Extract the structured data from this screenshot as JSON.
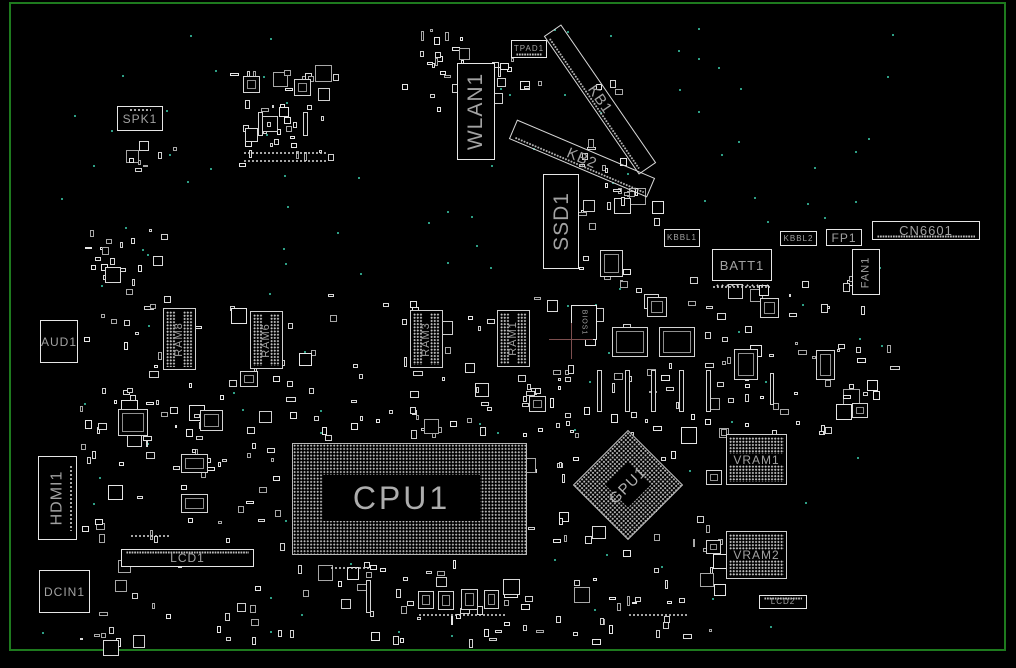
{
  "board": {
    "title": "motherboard-boardview",
    "bg_color": "#000000",
    "frame_color": "#1e7a1e",
    "outline_color": "#d9d9d9",
    "label_color": "#a2a2a2",
    "dot_color": "#c4c4c4",
    "testpoint_color": "#2e9e85",
    "crosshair": {
      "x": 571,
      "y": 339,
      "h_from": 549,
      "h_to": 593,
      "v_from": 323,
      "v_to": 359,
      "color": "#7d4f4f"
    },
    "frame": {
      "left": 9,
      "top": 2,
      "width": 997,
      "height": 649
    }
  },
  "components": [
    {
      "id": "spk1",
      "label": "SPK1",
      "kind": "box",
      "x": 117,
      "y": 106,
      "w": 46,
      "h": 25,
      "fs": 12,
      "pins": "top"
    },
    {
      "id": "tpad1",
      "label": "TPAD1",
      "kind": "box",
      "x": 511,
      "y": 40,
      "w": 36,
      "h": 18,
      "fs": 8,
      "hatch": "bottom"
    },
    {
      "id": "wlan1",
      "label": "WLAN1",
      "kind": "box",
      "x": 457,
      "y": 63,
      "w": 38,
      "h": 97,
      "fs": 21,
      "lrot": -90
    },
    {
      "id": "kb1",
      "label": "KB1",
      "kind": "diag",
      "x": 600,
      "y": 99,
      "w": 168,
      "h": 21,
      "fs": 15,
      "rot": 55.5
    },
    {
      "id": "kb2",
      "label": "KB2",
      "kind": "diag",
      "x": 582,
      "y": 158,
      "w": 150,
      "h": 21,
      "fs": 15,
      "rot": 23
    },
    {
      "id": "ssd1",
      "label": "SSD1",
      "kind": "box",
      "x": 543,
      "y": 174,
      "w": 36,
      "h": 95,
      "fs": 21,
      "lrot": -90
    },
    {
      "id": "kbbl1",
      "label": "KBBL1",
      "kind": "box",
      "x": 664,
      "y": 229,
      "w": 36,
      "h": 18,
      "fs": 8
    },
    {
      "id": "batt1",
      "label": "BATT1",
      "kind": "box",
      "x": 712,
      "y": 249,
      "w": 60,
      "h": 32,
      "fs": 13,
      "pins": "bottom"
    },
    {
      "id": "kbbl2",
      "label": "KBBL2",
      "kind": "box",
      "x": 780,
      "y": 231,
      "w": 37,
      "h": 15,
      "fs": 8
    },
    {
      "id": "fp1",
      "label": "FP1",
      "kind": "box",
      "x": 826,
      "y": 229,
      "w": 36,
      "h": 17,
      "fs": 12
    },
    {
      "id": "cn6601",
      "label": "CN6601",
      "kind": "box",
      "x": 872,
      "y": 221,
      "w": 108,
      "h": 19,
      "fs": 13,
      "hatch": "bottom"
    },
    {
      "id": "fan1",
      "label": "FAN1",
      "kind": "box",
      "x": 852,
      "y": 249,
      "w": 28,
      "h": 46,
      "fs": 11,
      "lrot": -90
    },
    {
      "id": "aud1",
      "label": "AUD1",
      "kind": "box",
      "x": 40,
      "y": 320,
      "w": 38,
      "h": 43,
      "fs": 12
    },
    {
      "id": "hdmi1",
      "label": "HDMI1",
      "kind": "box",
      "x": 38,
      "y": 456,
      "w": 39,
      "h": 84,
      "fs": 16,
      "lrot": -90,
      "pins": "right"
    },
    {
      "id": "dcin1",
      "label": "DCIN1",
      "kind": "box",
      "x": 39,
      "y": 570,
      "w": 51,
      "h": 43,
      "fs": 12
    },
    {
      "id": "lcd1",
      "label": "LCD1",
      "kind": "box",
      "x": 121,
      "y": 549,
      "w": 133,
      "h": 18,
      "fs": 12,
      "hatch": "top"
    },
    {
      "id": "ram8",
      "label": "RAM8",
      "kind": "ramv",
      "x": 163,
      "y": 308,
      "w": 33,
      "h": 62,
      "fs": 11
    },
    {
      "id": "ram6",
      "label": "RAM6",
      "kind": "ramv",
      "x": 250,
      "y": 311,
      "w": 33,
      "h": 58,
      "fs": 11
    },
    {
      "id": "ram3",
      "label": "RAM3",
      "kind": "ramv",
      "x": 410,
      "y": 310,
      "w": 33,
      "h": 58,
      "fs": 11
    },
    {
      "id": "ram1",
      "label": "RAM1",
      "kind": "ramv",
      "x": 497,
      "y": 310,
      "w": 33,
      "h": 57,
      "fs": 11
    },
    {
      "id": "bios1",
      "label": "BIOS1",
      "kind": "box",
      "x": 571,
      "y": 305,
      "w": 26,
      "h": 35,
      "fs": 7,
      "lrot": 90
    },
    {
      "id": "cpu1",
      "label": "CPU1",
      "kind": "cpu",
      "x": 292,
      "y": 443,
      "w": 235,
      "h": 112,
      "fs": 32
    },
    {
      "id": "gpu1",
      "label": "GPU1",
      "kind": "gpu",
      "x": 589,
      "y": 446,
      "w": 78,
      "h": 78,
      "fs": 15,
      "rot": 45
    },
    {
      "id": "vram1",
      "label": "VRAM1",
      "kind": "ramh",
      "x": 726,
      "y": 434,
      "w": 61,
      "h": 51,
      "fs": 12
    },
    {
      "id": "vram2",
      "label": "VRAM2",
      "kind": "ramh",
      "x": 726,
      "y": 531,
      "w": 61,
      "h": 48,
      "fs": 12
    },
    {
      "id": "lcd2",
      "label": "LCD2",
      "kind": "box",
      "x": 759,
      "y": 595,
      "w": 48,
      "h": 14,
      "fs": 8,
      "hatch": "top"
    }
  ],
  "texture": {
    "clusters": [
      [
        230,
        58,
        105,
        112,
        40,
        11
      ],
      [
        402,
        24,
        66,
        92,
        22,
        12
      ],
      [
        492,
        55,
        50,
        72,
        10,
        13
      ],
      [
        578,
        80,
        54,
        200,
        26,
        14
      ],
      [
        600,
        185,
        60,
        46,
        9,
        15
      ],
      [
        75,
        228,
        88,
        72,
        20,
        16
      ],
      [
        78,
        302,
        84,
        155,
        22,
        17
      ],
      [
        140,
        292,
        430,
        96,
        48,
        18
      ],
      [
        556,
        276,
        336,
        156,
        92,
        19
      ],
      [
        75,
        392,
        228,
        158,
        58,
        20
      ],
      [
        300,
        387,
        258,
        52,
        28,
        21
      ],
      [
        520,
        382,
        58,
        175,
        15,
        22
      ],
      [
        560,
        422,
        160,
        160,
        22,
        23
      ],
      [
        60,
        560,
        500,
        80,
        66,
        24
      ],
      [
        560,
        582,
        160,
        58,
        20,
        25
      ],
      [
        695,
        422,
        30,
        195,
        9,
        26
      ],
      [
        108,
        140,
        76,
        38,
        8,
        27
      ]
    ],
    "ics": [
      [
        612,
        327,
        36,
        30
      ],
      [
        659,
        327,
        36,
        30
      ],
      [
        734,
        349,
        24,
        31
      ],
      [
        816,
        350,
        19,
        30
      ],
      [
        181,
        454,
        27,
        19
      ],
      [
        181,
        494,
        27,
        19
      ],
      [
        118,
        409,
        30,
        27
      ],
      [
        647,
        297,
        20,
        20
      ],
      [
        760,
        298,
        19,
        20
      ],
      [
        600,
        250,
        23,
        27
      ],
      [
        418,
        591,
        16,
        18
      ],
      [
        438,
        591,
        16,
        19
      ],
      [
        461,
        589,
        17,
        21
      ],
      [
        484,
        590,
        15,
        19
      ],
      [
        243,
        76,
        17,
        17
      ],
      [
        294,
        79,
        17,
        17
      ],
      [
        200,
        410,
        23,
        21
      ],
      [
        529,
        396,
        17,
        16
      ],
      [
        852,
        403,
        16,
        15
      ],
      [
        240,
        371,
        18,
        16
      ],
      [
        706,
        470,
        16,
        15
      ],
      [
        706,
        540,
        15,
        14
      ]
    ],
    "vslots": [
      [
        258,
        112,
        5,
        24
      ],
      [
        303,
        112,
        5,
        24
      ],
      [
        597,
        370,
        5,
        42
      ],
      [
        625,
        370,
        5,
        42
      ],
      [
        651,
        370,
        5,
        42
      ],
      [
        679,
        370,
        5,
        42
      ],
      [
        706,
        370,
        5,
        42
      ],
      [
        366,
        580,
        5,
        33
      ],
      [
        770,
        373,
        4,
        32
      ]
    ],
    "hrows": [
      [
        243,
        151,
        85
      ],
      [
        243,
        159,
        85
      ],
      [
        712,
        285,
        58
      ],
      [
        130,
        534,
        40
      ],
      [
        418,
        613,
        88
      ],
      [
        628,
        613,
        60
      ],
      [
        330,
        566,
        40
      ]
    ],
    "testpoints": {
      "count": 125,
      "seed": 5,
      "x0": 58,
      "y0": 26,
      "x1": 893,
      "y1": 640,
      "extra": [
        [
          738,
          141
        ],
        [
          42,
          632
        ],
        [
          500,
          88
        ],
        [
          320,
          410
        ],
        [
          190,
          35
        ],
        [
          215,
          70
        ]
      ]
    }
  }
}
